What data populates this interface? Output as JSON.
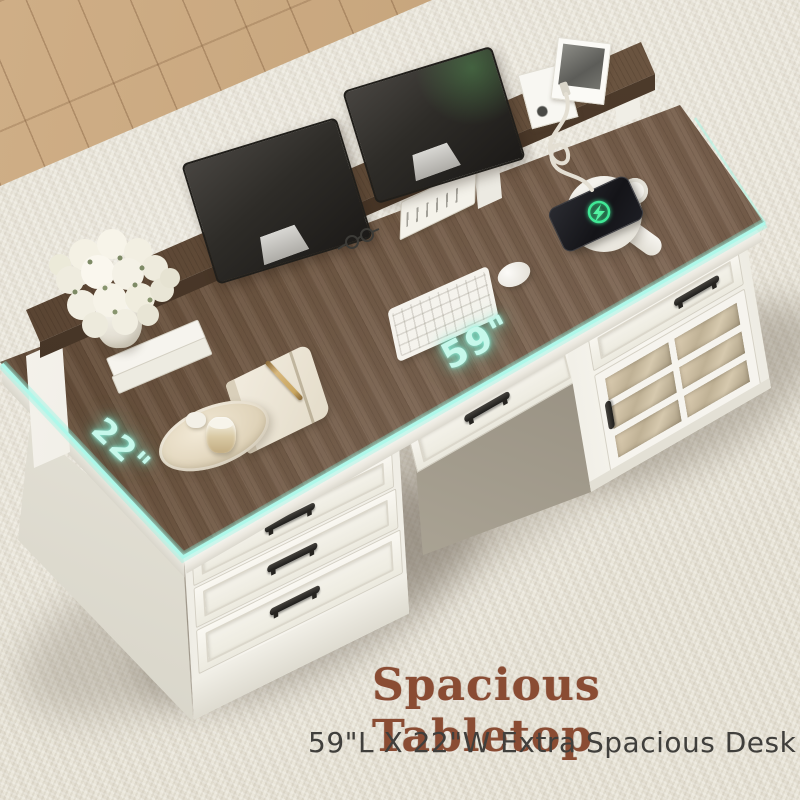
{
  "scene": {
    "type": "furniture-product-photo",
    "subject": "farmhouse executive desk with hutch riser, drawers and glass cabinet",
    "dimensions": {
      "length_label": "59\"",
      "width_label": "22\""
    },
    "caption": {
      "title": "Spacious Tabletop",
      "subtitle": "59\"L X 22\"W Extra Spacious Desk"
    },
    "colors": {
      "dimension_accent": "#aef8ea",
      "title_brown": "#8a4c33",
      "subtitle_gray": "#403f3c",
      "tabletop_wood": "#6b5342",
      "desk_body_white": "#f6f4ee",
      "rug_beige": "#eae6da",
      "floor_tan": "#c8a87e",
      "charging_green": "#3fe896"
    },
    "icons": {
      "charging_indicator": "lightning-bolt-in-ring"
    }
  }
}
